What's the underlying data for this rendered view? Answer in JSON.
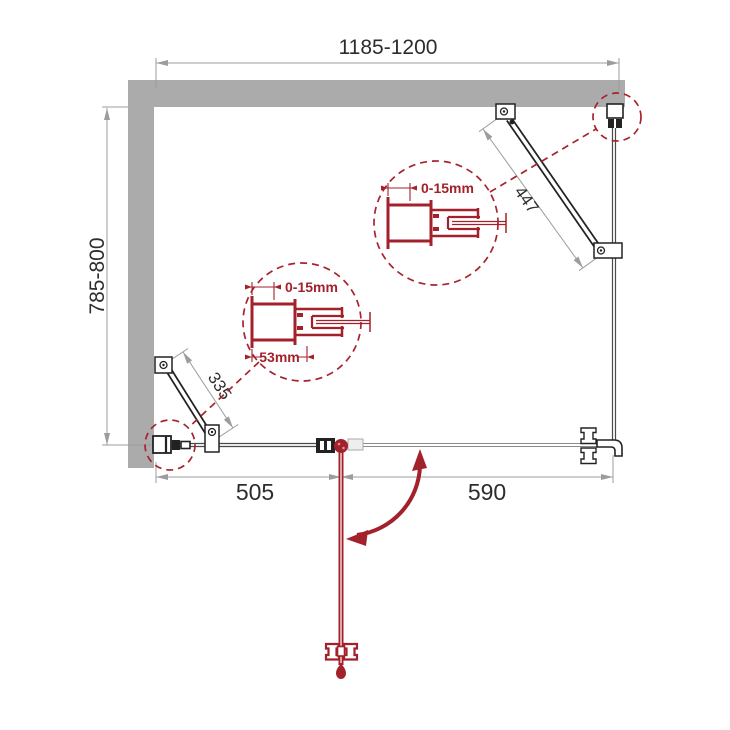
{
  "diagram": {
    "type": "shower-enclosure-plan-top-view",
    "colors": {
      "wall_gray": "#ababab",
      "hardware_black": "#222222",
      "dimension_gray": "#9c9ca0",
      "accent_red": "#a2212b",
      "glass_gray": "#555555"
    },
    "dims": {
      "top": "1185-1200",
      "left": "785-800",
      "fixed": "505",
      "door": "590",
      "brace_right": "447",
      "brace_left": "335"
    },
    "details": {
      "upper": {
        "adjustment": "0-15mm"
      },
      "lower": {
        "adjustment": "0-15mm",
        "width": "53mm"
      }
    }
  }
}
